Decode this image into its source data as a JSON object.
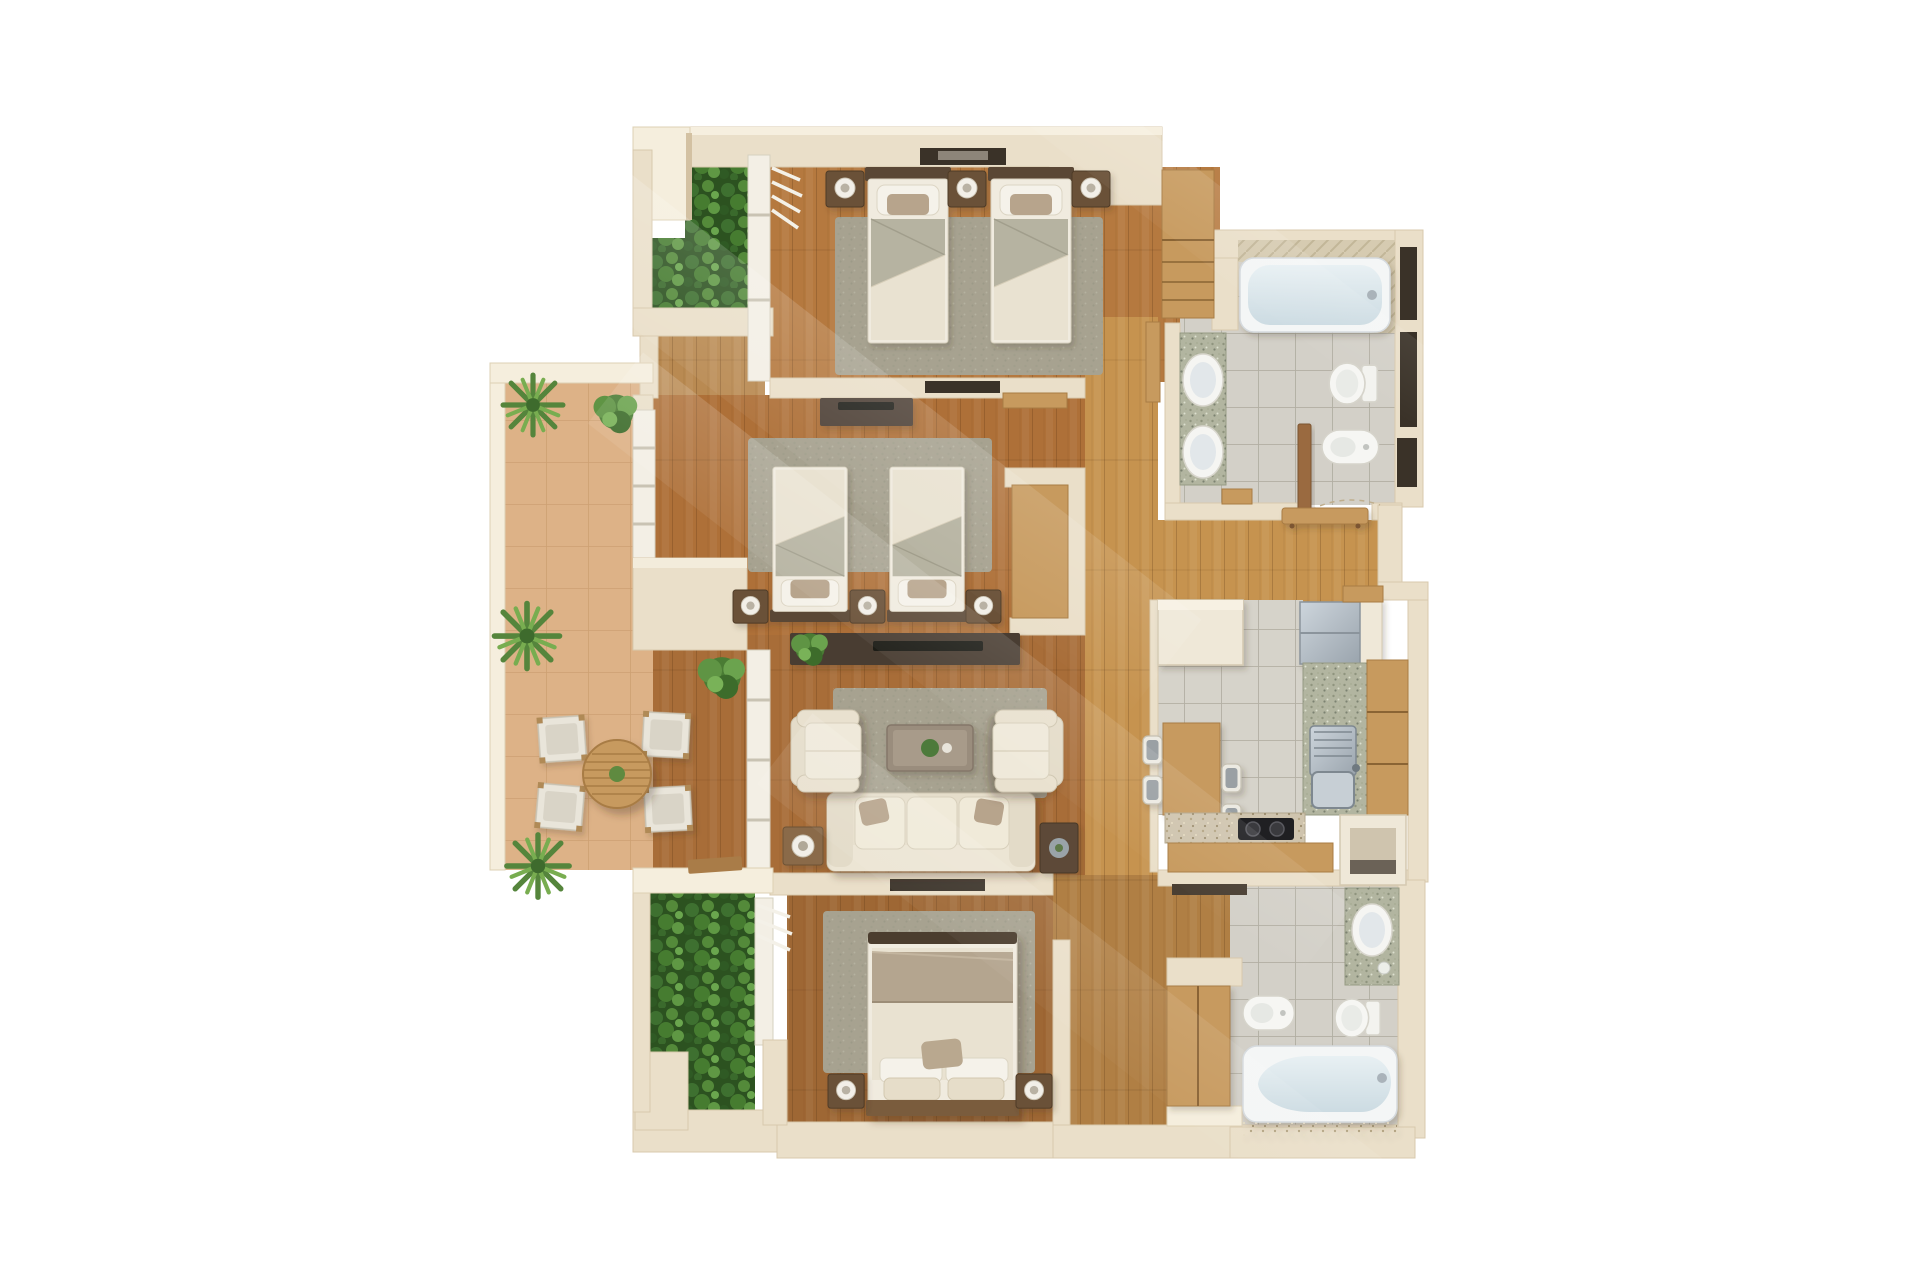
{
  "scene": {
    "title": "Top-down 3D render of an apartment floor plan",
    "style": "photorealistic 3D floor-plan render, top-down view, no visible text",
    "background": "#ffffff"
  },
  "palette": {
    "wall": "#eadfc9",
    "wall_light": "#f5eedd",
    "wall_shade": "#d3c1a2",
    "wood_floor": "#b5793f",
    "wood_floor_dark": "#9e6734",
    "hall_wood": "#c6934f",
    "oak_furniture": "#c79a5e",
    "dark_furniture": "#5c4936",
    "rug_sage": "#a7a290",
    "fabric_cream": "#eae3d3",
    "fabric_sage": "#b6b3a1",
    "pillow_taupe": "#b7a48c",
    "terrace_floor": "#ddb287",
    "tile_grey": "#d3d0c8",
    "granite_green": "#b2b5a0",
    "fixture_white": "#f5f5f2",
    "tub_water": "#dce7ec",
    "fridge_steel": "#b6bec6",
    "cooktop_black": "#1f1f22",
    "foliage_green": "#4e7a3a",
    "door_wood": "#9a6b3f"
  },
  "rooms": [
    {
      "id": "bedroom-top",
      "name": "Twin bedroom (top)",
      "floor": "hardwood",
      "furniture": [
        "twin bed",
        "twin bed",
        "nightstand x3",
        "table lamp x3",
        "area rug",
        "wall niche console",
        "built-in wardrobe"
      ]
    },
    {
      "id": "bathroom-top",
      "name": "Main bathroom (top right)",
      "floor": "grey ceramic tile",
      "fixtures": [
        "bathtub",
        "double-sink granite vanity",
        "toilet",
        "bidet",
        "storage niches",
        "wood door"
      ]
    },
    {
      "id": "bedroom-middle",
      "name": "Twin bedroom (middle)",
      "floor": "hardwood",
      "furniture": [
        "twin bed",
        "twin bed",
        "nightstand x3",
        "media console with TV",
        "desk unit",
        "area rug",
        "terrace window"
      ]
    },
    {
      "id": "living-room",
      "name": "Living room",
      "floor": "hardwood",
      "furniture": [
        "three-seat sofa",
        "armchair x2",
        "coffee table with plant",
        "media console with TV",
        "side table with lamp",
        "side table with bowl",
        "area rug",
        "potted fern"
      ]
    },
    {
      "id": "kitchen",
      "name": "Kitchen",
      "floor": "ceramic tile",
      "furniture": [
        "refrigerator",
        "upper cabinet",
        "stainless sink with drainboard",
        "granite counters",
        "wood cabinet run",
        "dining table",
        "chair x4",
        "two-burner cooktop",
        "appliance niche"
      ]
    },
    {
      "id": "bedroom-bottom",
      "name": "Master bedroom (bottom)",
      "floor": "hardwood",
      "furniture": [
        "double bed",
        "nightstand x2",
        "table lamp x2",
        "area rug",
        "wall TV",
        "louvered window"
      ]
    },
    {
      "id": "bathroom-bottom",
      "name": "Second bathroom (bottom right)",
      "floor": "grey ceramic tile",
      "fixtures": [
        "bathtub",
        "granite vanity with oval sink",
        "toilet",
        "bidet",
        "tall wood cabinet",
        "wall shelf"
      ]
    },
    {
      "id": "terrace",
      "name": "Terrace",
      "floor": "terracotta tile",
      "furniture": [
        "round slatted table",
        "outdoor chair x4",
        "potted palm x3",
        "potted shrub x2",
        "parapet railing",
        "wood tray"
      ]
    },
    {
      "id": "planter-top",
      "name": "Planter bed (top left)",
      "contents": [
        "dense green shrubs"
      ]
    },
    {
      "id": "planter-bottom",
      "name": "Planter bed (bottom left)",
      "contents": [
        "palms and ferns"
      ]
    },
    {
      "id": "hallway",
      "name": "Hallway",
      "floor": "hardwood",
      "furniture": [
        "console table",
        "bench",
        "wall shelf"
      ]
    },
    {
      "id": "entry-nook",
      "name": "Entry nook",
      "floor": "hardwood"
    }
  ]
}
